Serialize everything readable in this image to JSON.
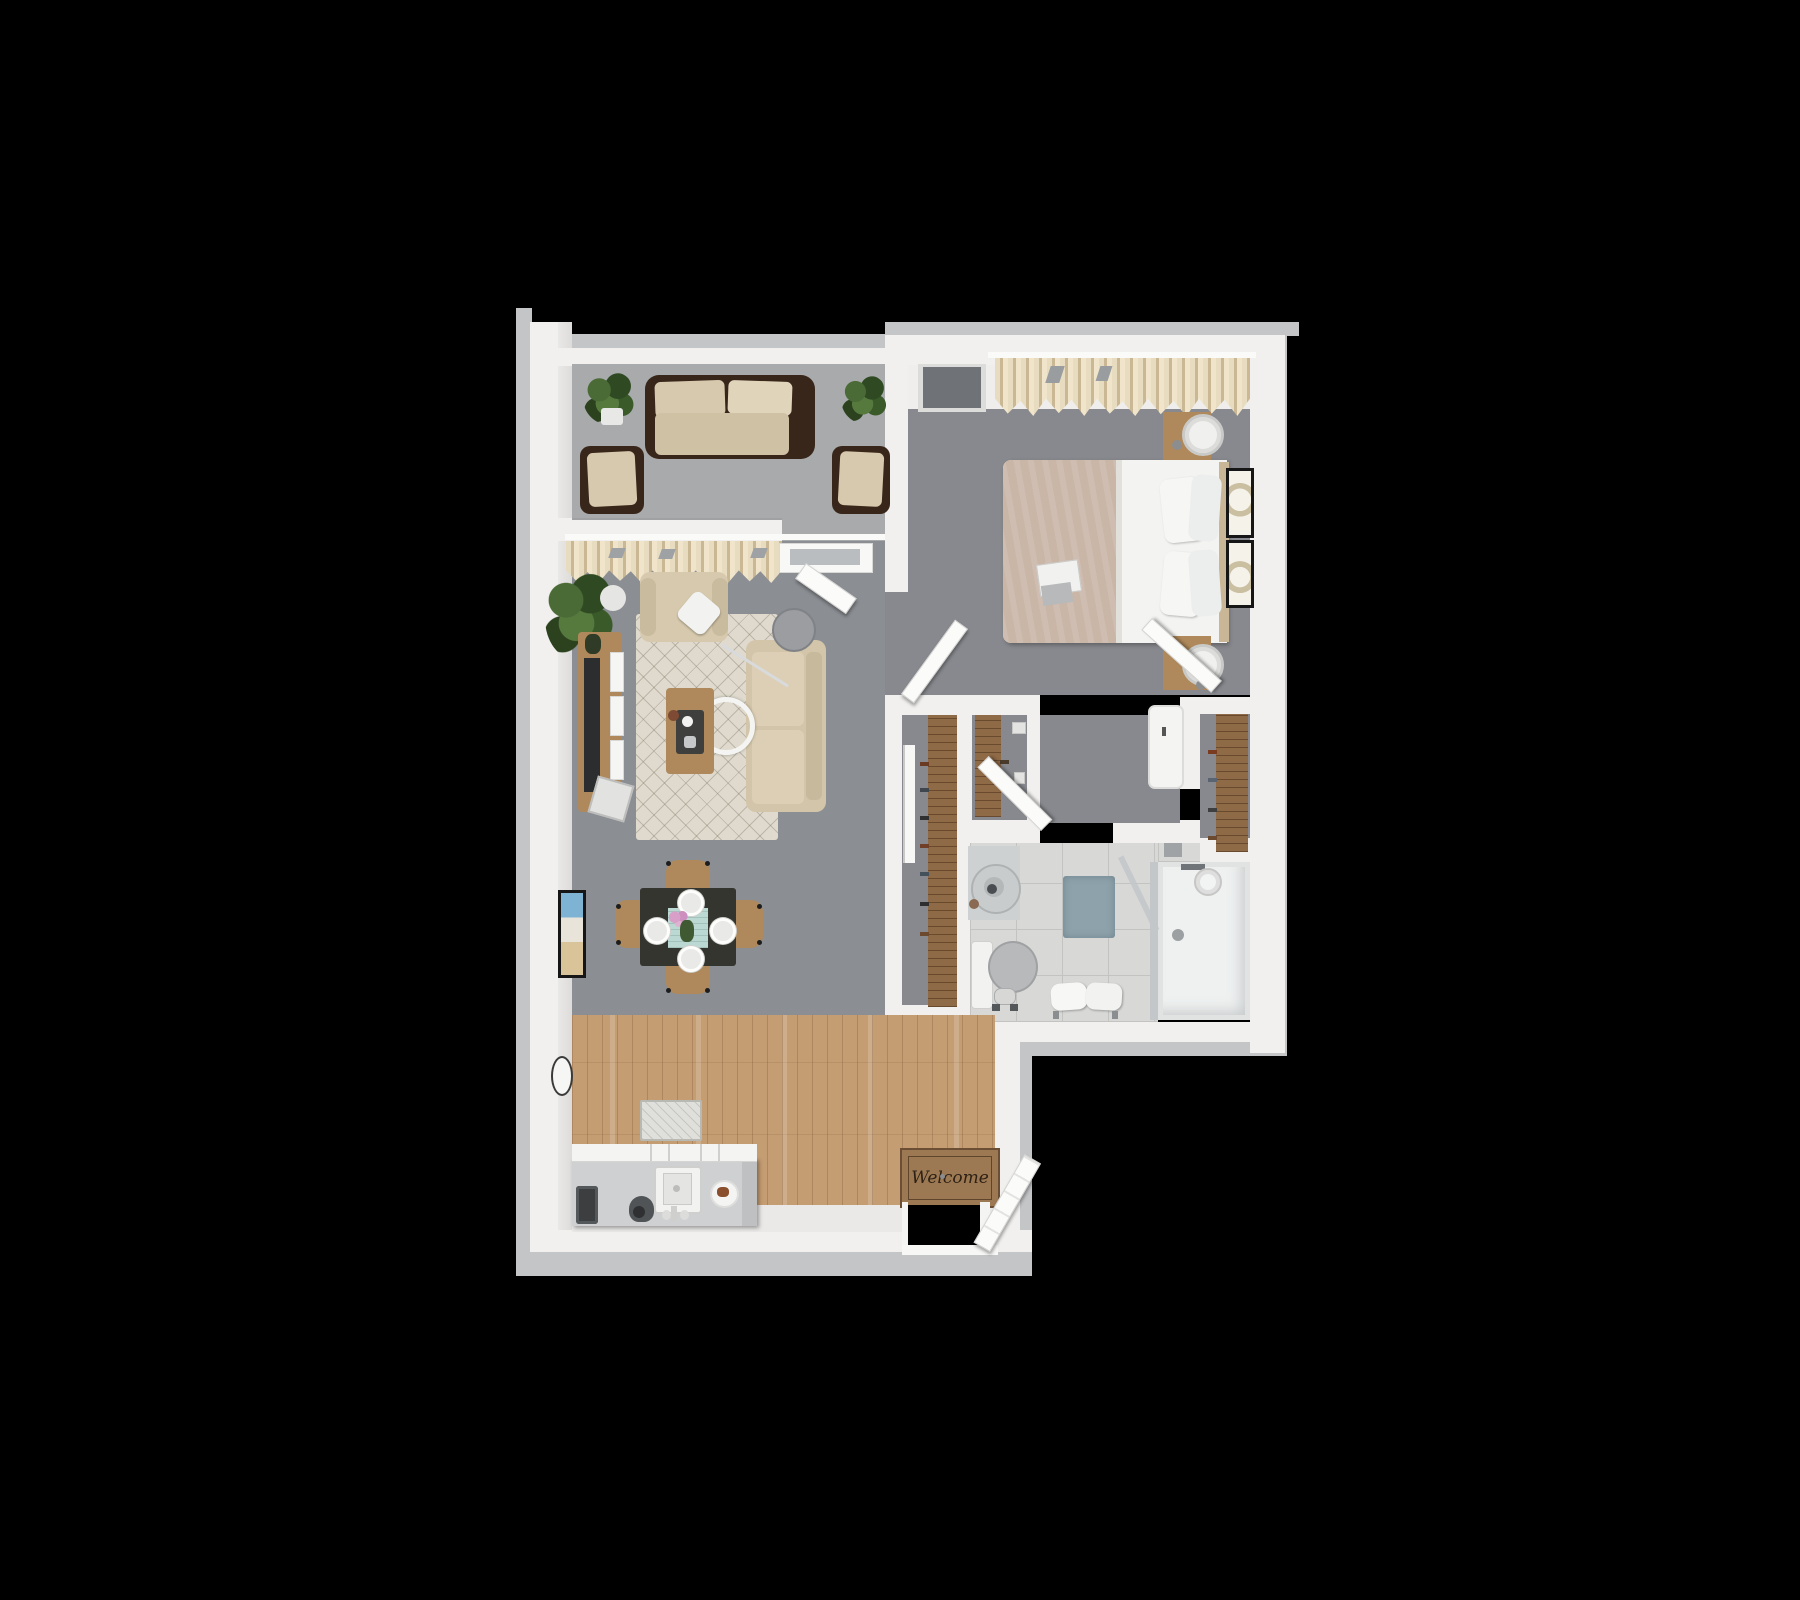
{
  "scene": {
    "type": "3d-floor-plan-top-down-render",
    "background_color": "#000000",
    "units": "pixels",
    "description_only_visible_text": true
  },
  "entry": {
    "mat_text": "Welcome"
  },
  "colors": {
    "background": "#000000",
    "wall_white": "#f1f0ee",
    "wall_outer_gray": "#c4c5c7",
    "balcony_carpet": "#a8aaac",
    "living_carpet": "#8b8e93",
    "bedroom_carpet": "#87898e",
    "wood_floor": "#c59d73",
    "bathroom_tile": "#d8d8d6",
    "closet_wood": "#8f6a47",
    "furniture_wood": "#af895b",
    "sofa_beige": "#d7c9ad",
    "wicker_brown": "#38261a",
    "bed_blanket_tan": "#c9b6a7",
    "curtain_beige": "#e8dcc0",
    "area_rug": "#dfdacd",
    "bath_mat_blue": "#8ea2ac",
    "welcome_mat_brown": "#9c7952",
    "table_runner_teal": "#bcd8d2",
    "flower_pink": "#d8a0c8"
  },
  "rooms": {
    "balcony": {
      "floor": "gray carpet",
      "furniture": [
        "wicker-sofa",
        "wicker-chair-left",
        "wicker-chair-right",
        "potted-plant-left",
        "potted-plant-right"
      ]
    },
    "living_room": {
      "floor": "gray carpet",
      "furniture": [
        "window-curtains",
        "floor-plant",
        "tv-console",
        "television",
        "magazine-rack",
        "area-rug",
        "armchair",
        "throw-pillow",
        "loveseat-sofa",
        "floor-lamp",
        "pendant-lamp-ring",
        "coffee-table",
        "balcony-door"
      ]
    },
    "dining_area": {
      "floor": "gray carpet",
      "furniture": [
        "dining-table",
        "dining-chairs-4",
        "place-settings-4",
        "flower-centerpiece",
        "table-runner",
        "wall-art-beach",
        "wall-clock"
      ]
    },
    "bedroom": {
      "floor": "gray carpet",
      "furniture": [
        "window-curtains",
        "wall-window-panel",
        "queen-bed",
        "pillows-4",
        "breakfast-tray",
        "nightstand-top",
        "nightstand-bottom",
        "table-lamps-2",
        "wall-art-frames-2",
        "wall-cabinet",
        "closet-nook-shelf"
      ]
    },
    "hallway": {
      "floor": "gray carpet",
      "furniture": [
        "closet-shelf-left",
        "closet-shelf-right",
        "closet-door-panel"
      ]
    },
    "bathroom": {
      "floor": "tile",
      "furniture": [
        "round-sink",
        "faucet",
        "toilet",
        "toilet-paper-stand",
        "bath-mat",
        "towel-bench",
        "walk-in-shower",
        "shower-head",
        "shower-glass",
        "floor-drain"
      ]
    },
    "kitchen": {
      "floor": "wood planks",
      "furniture": [
        "kitchen-island",
        "toaster",
        "stand-mixer",
        "island-sink",
        "food-plate",
        "small-rug",
        "welcome-mat",
        "entry-door"
      ]
    }
  }
}
